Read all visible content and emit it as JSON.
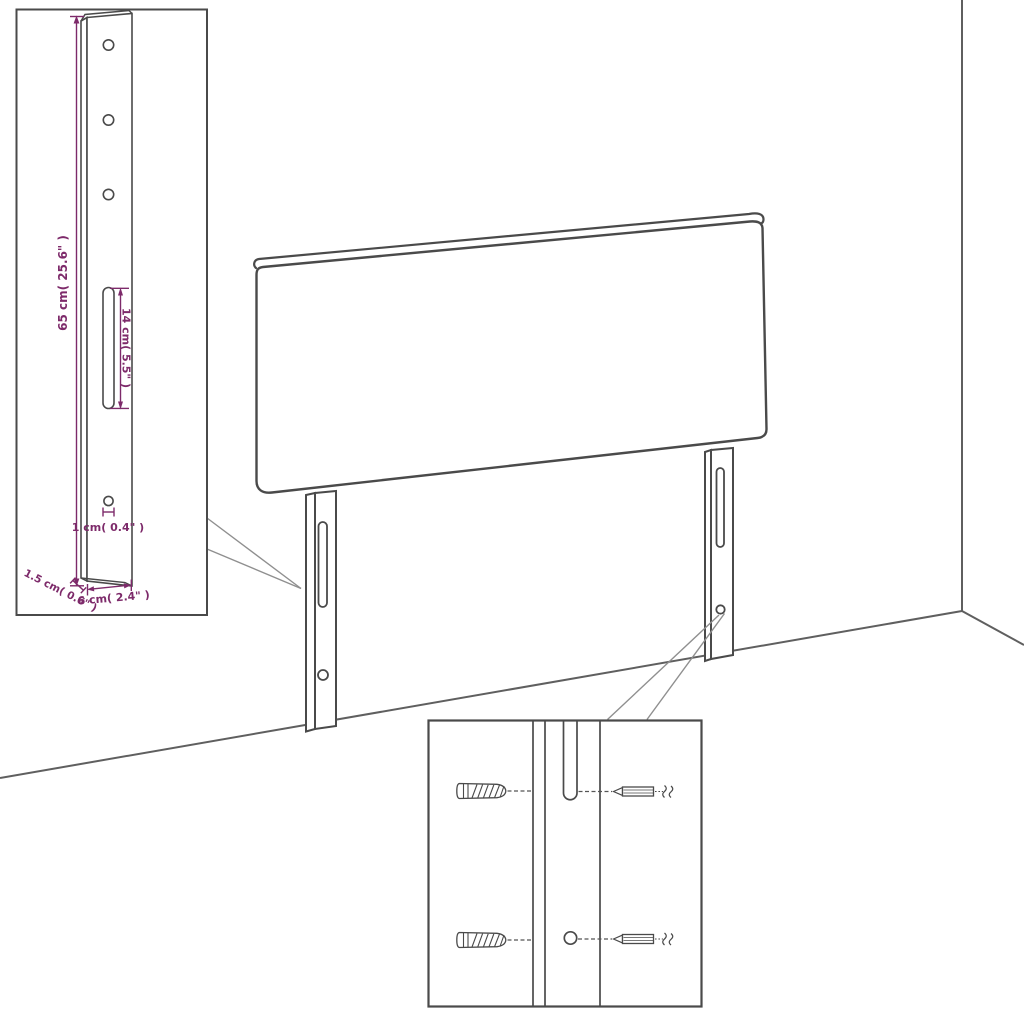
{
  "diagram": {
    "subject": "Headboard with two slotted mounting legs shown against a room corner, with a leg dimension inset and a wall-plug and screw mounting detail inset",
    "background_color": "#ffffff",
    "line_color": "#4a4a4a",
    "accent_color": "#7d2a6a"
  },
  "leg_detail_inset": {
    "height_label": "65 cm( 25.6\" )",
    "slot_length_label": "14 cm( 5.5\" )",
    "hole_diameter_label": "1 cm( 0.4\" )",
    "thickness_label": "1.5 cm( 0.6\" )",
    "width_label": "6 cm( 2.4\" )",
    "screw_hole_count": 3
  },
  "mounting_detail_inset": {
    "wall_plug_count": 2,
    "screw_count": 2
  }
}
